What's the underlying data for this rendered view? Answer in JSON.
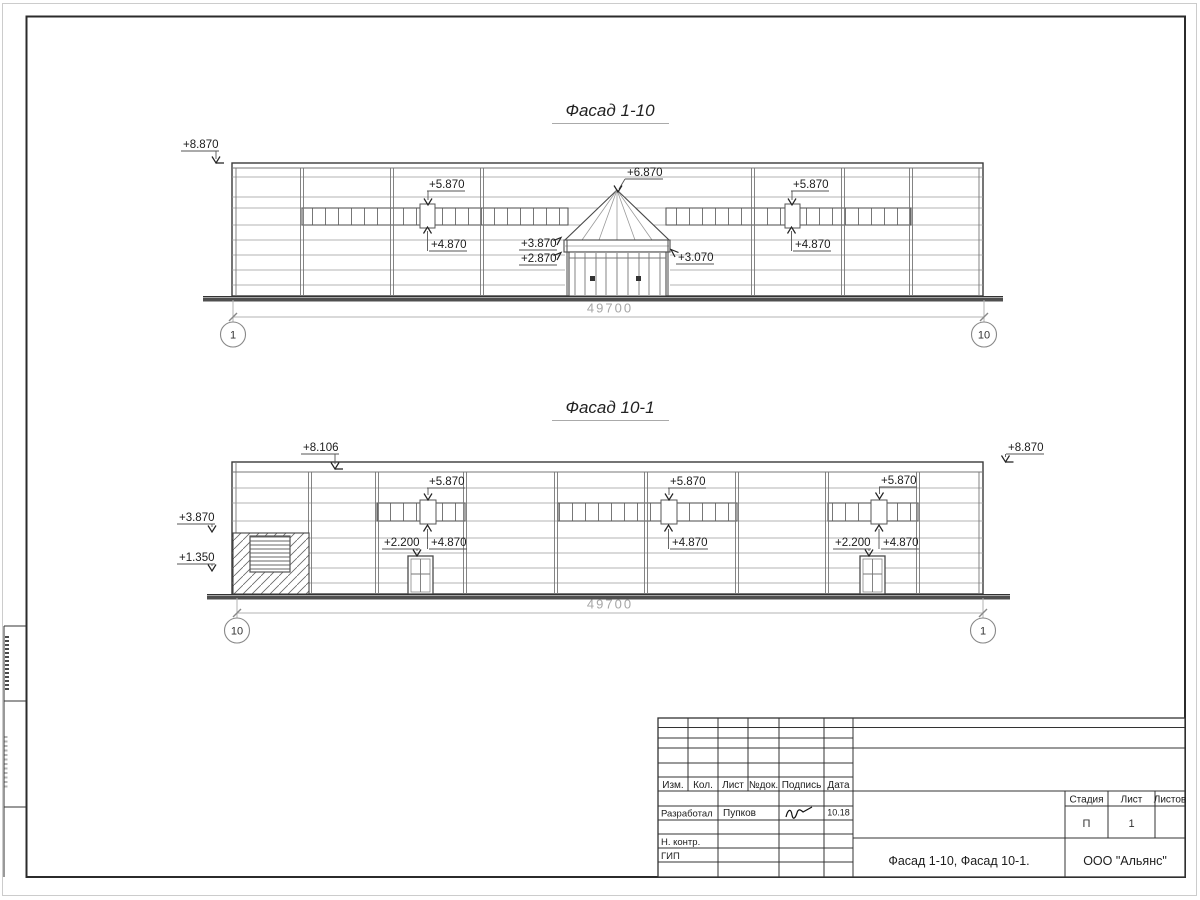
{
  "facade1": {
    "title": "Фасад 1-10",
    "dimension": "49700",
    "axis_left": "1",
    "axis_right": "10",
    "marks": {
      "left_top": "+8.870",
      "band_left_top": "+5.870",
      "band_left_bottom": "+4.870",
      "apex": "+6.870",
      "canopy_top": "+3.870",
      "canopy_bottom": "+2.870",
      "canopy_right": "+3.070",
      "band_right_top": "+5.870",
      "band_right_bottom": "+4.870"
    }
  },
  "facade2": {
    "title": "Фасад 10-1",
    "dimension": "49700",
    "axis_left": "10",
    "axis_right": "1",
    "marks": {
      "roof_left": "+8.106",
      "roof_right": "+8.870",
      "hatch_top": "+3.870",
      "hatch_bottom": "+1.350",
      "band_a_top": "+5.870",
      "band_a_bottom": "+4.870",
      "door_a": "+2.200",
      "band_b_top": "+5.870",
      "band_b_bottom": "+4.870",
      "band_c_top": "+5.870",
      "band_c_bottom": "+4.870",
      "door_c": "+2.200"
    }
  },
  "title_block": {
    "rev_headers": [
      "Изм.",
      "Кол.",
      "Лист",
      "№док.",
      "Подпись",
      "Дата"
    ],
    "developed_label": "Разработал",
    "developed_name": "Пупков",
    "developed_date": "10.18",
    "n_contr_label": "Н. контр.",
    "gip_label": "ГИП",
    "doc_title": "Фасад 1-10, Фасад 10-1.",
    "company": "ООО \"Альянс\"",
    "stage_header": "Стадия",
    "sheet_header": "Лист",
    "sheets_header": "Листов",
    "stage_value": "П",
    "sheet_value": "1",
    "sheets_value": ""
  },
  "colors": {
    "line": "#3a3a3a",
    "panel_line": "#9a9a9a",
    "dimension": "#b3b3b3",
    "ground": "#4f4f4f"
  }
}
